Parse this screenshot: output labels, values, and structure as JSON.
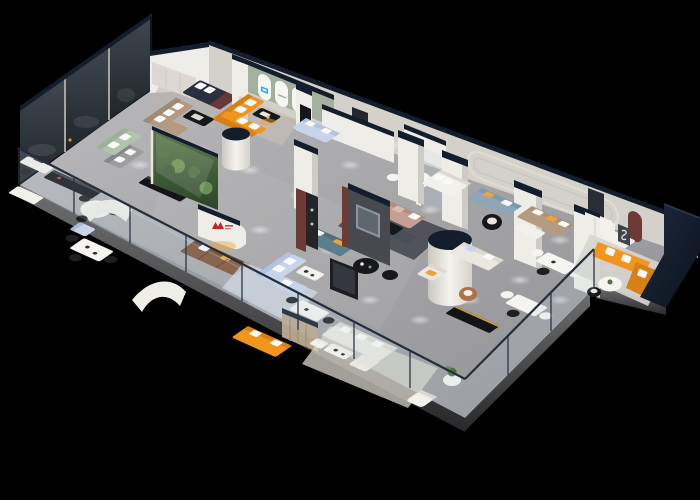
{
  "scene": {
    "type": "3d-isometric-floorplan-render",
    "subject": "furniture showroom upper floor, cutaway isometric view",
    "background": "#000000"
  },
  "palette": {
    "background": "#000000",
    "floor": "#a8a8aa",
    "slab": "#58585a",
    "wall_white": "#efede7",
    "wall_shade": "#ddd9d2",
    "wall_back": "#d4d1cb",
    "cap_navy": "#141d2b",
    "glass_dark": "#39434a",
    "glass_tint": "#c3d4e0",
    "rail_frame": "#232e3d",
    "green_wall": "#a3b09e",
    "orange": "#f2951f",
    "orange_deep": "#d87f16",
    "tan": "#b59a82",
    "brown": "#7c5034",
    "blush": "#c5a092",
    "teal": "#5d7f8d",
    "periwinkle": "#c7d4ec",
    "sage": "#b0c3ad",
    "cream": "#eae8e0",
    "blue_gray": "#8fa6b8",
    "black_furniture": "#17181a",
    "maroon": "#6d3a35",
    "red_logo": "#c22127",
    "blue_logo": "#2f9fd8",
    "plant": "#4e7040",
    "amber": "#eda33c",
    "rug_dark": "#41444b",
    "rug_light": "#d7d4ca",
    "rug_blue": "#d3d9e4",
    "wood": "#b5a48c",
    "navy_wall": "#16213a"
  },
  "logos": [
    {
      "name": "red-m-logo",
      "location": "curved white wall, center-left"
    },
    {
      "name": "blue-m-logo",
      "location": "arched niche, green wall room"
    },
    {
      "name": "s-curve-art",
      "location": "dark wall panel, right room"
    }
  ],
  "zones": [
    {
      "name": "smoked-glass-offices",
      "items": [
        "dark glass panels",
        "gray sofa",
        "white desks",
        "black consoles"
      ]
    },
    {
      "name": "arch-room",
      "items": [
        "green wall with three white arches",
        "orange L sofa",
        "black coffee table"
      ]
    },
    {
      "name": "left-showroom",
      "items": [
        "sage sofa",
        "tan sectional",
        "plant glass display",
        "dining table"
      ]
    },
    {
      "name": "center-showroom",
      "items": [
        "brown leather sofa",
        "periwinkle sectional",
        "teal sofa",
        "blush sectional",
        "dark partition with tv",
        "round black tables"
      ]
    },
    {
      "name": "right-showroom",
      "items": [
        "navy-capped pillars",
        "blue-gray sofa",
        "tan sofa",
        "cream sofa",
        "white cylinder column",
        "dining sets"
      ]
    },
    {
      "name": "orange-room-right",
      "items": [
        "orange L sofa",
        "round white table",
        "wall art panels"
      ]
    },
    {
      "name": "bottom-showroom",
      "items": [
        "cream sectional",
        "orange sofa",
        "wood slat partition",
        "white armchair",
        "plant side table"
      ]
    },
    {
      "name": "balcony-railing",
      "items": [
        "glass panels",
        "navy top rail",
        "posts"
      ]
    }
  ]
}
